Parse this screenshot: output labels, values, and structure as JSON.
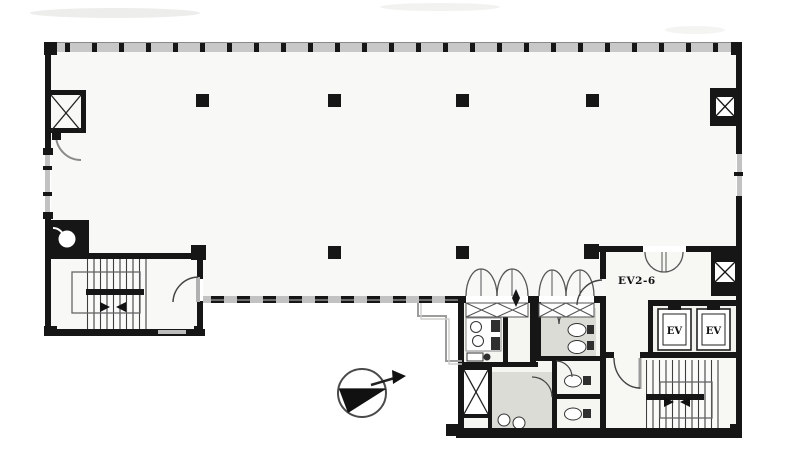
{
  "plan": {
    "labels": {
      "ev_hall": "EV2-6",
      "elevator_left": "EV",
      "elevator_right": "EV"
    },
    "symbols": {
      "north_arrow": "compass-north-arrow",
      "left_stair": "staircase-with-direction-arrows",
      "right_stair": "staircase-with-direction-arrows",
      "shafts": "x-braced-duct-shaft",
      "entry_mats": "x-crossed-threshold",
      "doors": "quarter-circle-door-swing"
    },
    "colors": {
      "wall": "#161616",
      "window_mullion": "#c2c2c2",
      "floor": "#f8f8f6",
      "wet_area_floor": "#dcdcd7",
      "paper": "#ffffff"
    }
  }
}
